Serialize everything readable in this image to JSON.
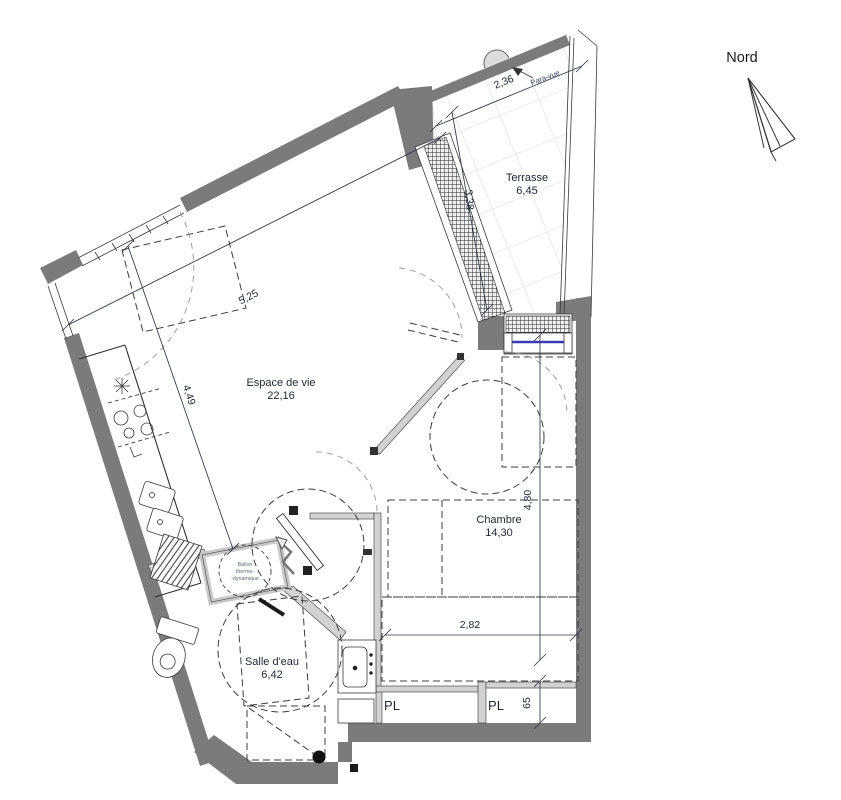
{
  "compass": {
    "label": "Nord"
  },
  "rooms": {
    "terrasse": {
      "name": "Terrasse",
      "area": "6,45"
    },
    "espace_de_vie": {
      "name": "Espace de vie",
      "area": "22,16"
    },
    "chambre": {
      "name": "Chambre",
      "area": "14,30"
    },
    "salle_deau": {
      "name": "Salle d'eau",
      "area": "6,42"
    },
    "placard_1": {
      "name": "PL"
    },
    "placard_2": {
      "name": "PL"
    }
  },
  "equipment": {
    "para_vue": "Para-vue",
    "ballon_line1": "Ballon",
    "ballon_line2": "thermo-",
    "ballon_line3": "-dynamique"
  },
  "dimensions": {
    "terrasse_width": "2,36",
    "terrasse_depth": "3,38",
    "living_width": "5,25",
    "living_depth": "4,49",
    "chambre_depth": "4,80",
    "chambre_width": "2,82",
    "placard_depth": "65"
  },
  "colors": {
    "wall": "#7b7b7b",
    "partition": "#d2d2d2",
    "window": "#3a3ab8",
    "text": "#1e2633"
  }
}
